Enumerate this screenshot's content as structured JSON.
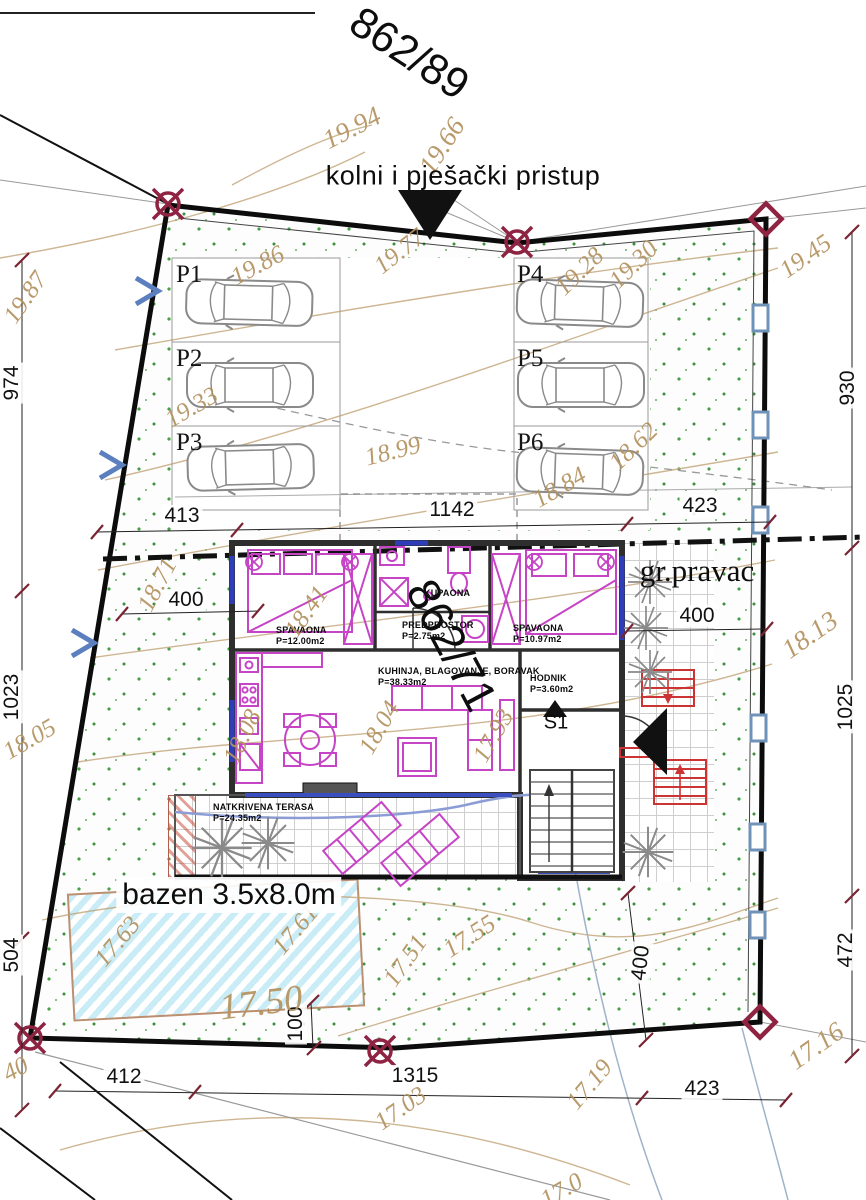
{
  "labels": {
    "parcel_top": "862/89",
    "parcel_mid": "862/71",
    "access": "kolni i pješački pristup",
    "boundary_direction": "gr.pravac",
    "pool": "bazen 3.5x8.0m",
    "stair": "S1"
  },
  "rooms": [
    {
      "name": "SPAVAONA",
      "area": "P=12.00m2",
      "x": 276,
      "y": 625
    },
    {
      "name": "PREDPROSTOR",
      "area": "P=2.75m2",
      "x": 402,
      "y": 620
    },
    {
      "name": "KUPAONA",
      "area": "",
      "x": 424,
      "y": 588
    },
    {
      "name": "SPAVAONA",
      "area": "P=10.97m2",
      "x": 513,
      "y": 623
    },
    {
      "name": "KUHINJA, BLAGOVANJE, BORAVAK",
      "area": "P=38.33m2",
      "x": 378,
      "y": 666
    },
    {
      "name": "HODNIK",
      "area": "P=3.60m2",
      "x": 530,
      "y": 673
    },
    {
      "name": "NATKRIVENA TERASA",
      "area": "P=24.35m2",
      "x": 213,
      "y": 802
    }
  ],
  "parking": [
    {
      "label": "P1",
      "x": 176,
      "y": 261
    },
    {
      "label": "P2",
      "x": 176,
      "y": 345
    },
    {
      "label": "P3",
      "x": 176,
      "y": 429
    },
    {
      "label": "P4",
      "x": 517,
      "y": 261
    },
    {
      "label": "P5",
      "x": 517,
      "y": 345
    },
    {
      "label": "P6",
      "x": 517,
      "y": 429
    }
  ],
  "dimensions": [
    {
      "v": "413",
      "x": 182,
      "y": 516,
      "r": 0
    },
    {
      "v": "1142",
      "x": 452,
      "y": 510,
      "r": 0
    },
    {
      "v": "423",
      "x": 700,
      "y": 506,
      "r": 0
    },
    {
      "v": "400",
      "x": 186,
      "y": 600,
      "r": 0
    },
    {
      "v": "400",
      "x": 697,
      "y": 616,
      "r": 0
    },
    {
      "v": "412",
      "x": 124,
      "y": 1077,
      "r": 0
    },
    {
      "v": "1315",
      "x": 415,
      "y": 1076,
      "r": 0
    },
    {
      "v": "423",
      "x": 702,
      "y": 1089,
      "r": 0
    },
    {
      "v": "974",
      "x": 12,
      "y": 383,
      "r": -90
    },
    {
      "v": "1023",
      "x": 12,
      "y": 697,
      "r": -90
    },
    {
      "v": "504",
      "x": 12,
      "y": 955,
      "r": -90
    },
    {
      "v": "930",
      "x": 848,
      "y": 388,
      "r": -90
    },
    {
      "v": "1025",
      "x": 846,
      "y": 707,
      "r": -90
    },
    {
      "v": "472",
      "x": 846,
      "y": 950,
      "r": -90
    },
    {
      "v": "100",
      "x": 296,
      "y": 1024,
      "r": -90
    },
    {
      "v": "400",
      "x": 641,
      "y": 963,
      "r": -83
    }
  ],
  "contours": [
    {
      "v": "19.94",
      "x": 352,
      "y": 128,
      "r": -27,
      "s": 27
    },
    {
      "v": "19.66",
      "x": 442,
      "y": 146,
      "r": -57,
      "s": 27
    },
    {
      "v": "19.77",
      "x": 400,
      "y": 252,
      "r": -38,
      "s": 25
    },
    {
      "v": "19.87",
      "x": 26,
      "y": 298,
      "r": -55,
      "s": 25
    },
    {
      "v": "19.86",
      "x": 258,
      "y": 266,
      "r": -28,
      "s": 25
    },
    {
      "v": "19.33",
      "x": 192,
      "y": 408,
      "r": -30,
      "s": 25
    },
    {
      "v": "19.28",
      "x": 580,
      "y": 272,
      "r": -44,
      "s": 25
    },
    {
      "v": "19.30",
      "x": 634,
      "y": 265,
      "r": -44,
      "s": 25
    },
    {
      "v": "19.45",
      "x": 806,
      "y": 257,
      "r": -35,
      "s": 25
    },
    {
      "v": "18.99",
      "x": 393,
      "y": 452,
      "r": -14,
      "s": 25
    },
    {
      "v": "18.84",
      "x": 560,
      "y": 488,
      "r": -30,
      "s": 25
    },
    {
      "v": "18.62",
      "x": 634,
      "y": 447,
      "r": -44,
      "s": 25
    },
    {
      "v": "18.71",
      "x": 158,
      "y": 585,
      "r": -62,
      "s": 25
    },
    {
      "v": "18.41",
      "x": 307,
      "y": 612,
      "r": -55,
      "s": 25
    },
    {
      "v": "18.13",
      "x": 810,
      "y": 635,
      "r": -35,
      "s": 27
    },
    {
      "v": "18.05",
      "x": 30,
      "y": 740,
      "r": -30,
      "s": 25
    },
    {
      "v": "18.08",
      "x": 243,
      "y": 737,
      "r": -64,
      "s": 25
    },
    {
      "v": "18.04",
      "x": 380,
      "y": 728,
      "r": -60,
      "s": 25
    },
    {
      "v": "17.93",
      "x": 494,
      "y": 736,
      "r": -60,
      "s": 25
    },
    {
      "v": "17.63",
      "x": 118,
      "y": 942,
      "r": -50,
      "s": 25
    },
    {
      "v": "17.61",
      "x": 296,
      "y": 930,
      "r": -50,
      "s": 25
    },
    {
      "v": "17.55",
      "x": 470,
      "y": 937,
      "r": -33,
      "s": 25
    },
    {
      "v": "17.51",
      "x": 406,
      "y": 961,
      "r": -55,
      "s": 25
    },
    {
      "v": "17.50",
      "x": 261,
      "y": 1003,
      "r": -7,
      "s": 37
    },
    {
      "v": "17.19",
      "x": 590,
      "y": 1085,
      "r": -50,
      "s": 25
    },
    {
      "v": "17.16",
      "x": 816,
      "y": 1046,
      "r": -35,
      "s": 27
    },
    {
      "v": "17.03",
      "x": 401,
      "y": 1109,
      "r": -35,
      "s": 25
    },
    {
      "v": "40",
      "x": 16,
      "y": 1070,
      "r": -28,
      "s": 25
    },
    {
      "v": "17.0",
      "x": 562,
      "y": 1191,
      "r": -30,
      "s": 25
    }
  ],
  "colors": {
    "contour_text": "#b3925f",
    "boundary": "#0c0c0c",
    "survey_marker": "#8e2342",
    "furniture": "#c644c6",
    "grass_dot": "#4aa04a",
    "pool_fill": "#c9ecf6",
    "stairs_red": "#cc3333",
    "window_blue": "#2f3db8"
  }
}
